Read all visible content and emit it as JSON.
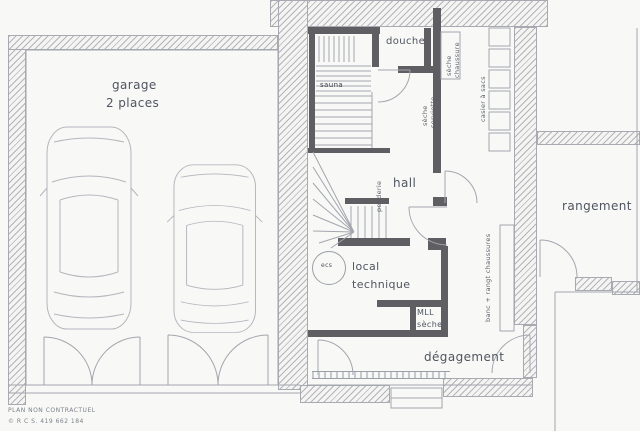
{
  "rooms": {
    "garage": {
      "label": "garage",
      "capacity": "2 places"
    },
    "sauna": {
      "label": "sauna"
    },
    "douche": {
      "label": "douche"
    },
    "hall": {
      "label": "hall"
    },
    "local_technique": {
      "line1": "local",
      "line2": "technique"
    },
    "degagement": {
      "label": "dégagement"
    },
    "rangement": {
      "label": "rangement"
    }
  },
  "fixtures": {
    "seche_chaussure": {
      "line1": "sèche",
      "line2": "chaussure"
    },
    "seche_serviette": {
      "line1": "sèche",
      "line2": "serviette"
    },
    "casier_a_sacs": {
      "label": "casier à sacs"
    },
    "penderie": {
      "label": "penderie"
    },
    "ecs": {
      "label": "ecs"
    },
    "laundry": {
      "line1": "MLL",
      "line2": "sèche"
    },
    "banc_rangt": {
      "label": "banc + rangt chaussures"
    }
  },
  "footer": {
    "disclaimer": "PLAN NON CONTRACTUEL",
    "registration": "© R C S. 419 662 184"
  },
  "colors": {
    "paper": "#f8f8f6",
    "ink": "#9aa0a8",
    "wall_dark": "#5e5e63",
    "text": "#4f5560"
  }
}
